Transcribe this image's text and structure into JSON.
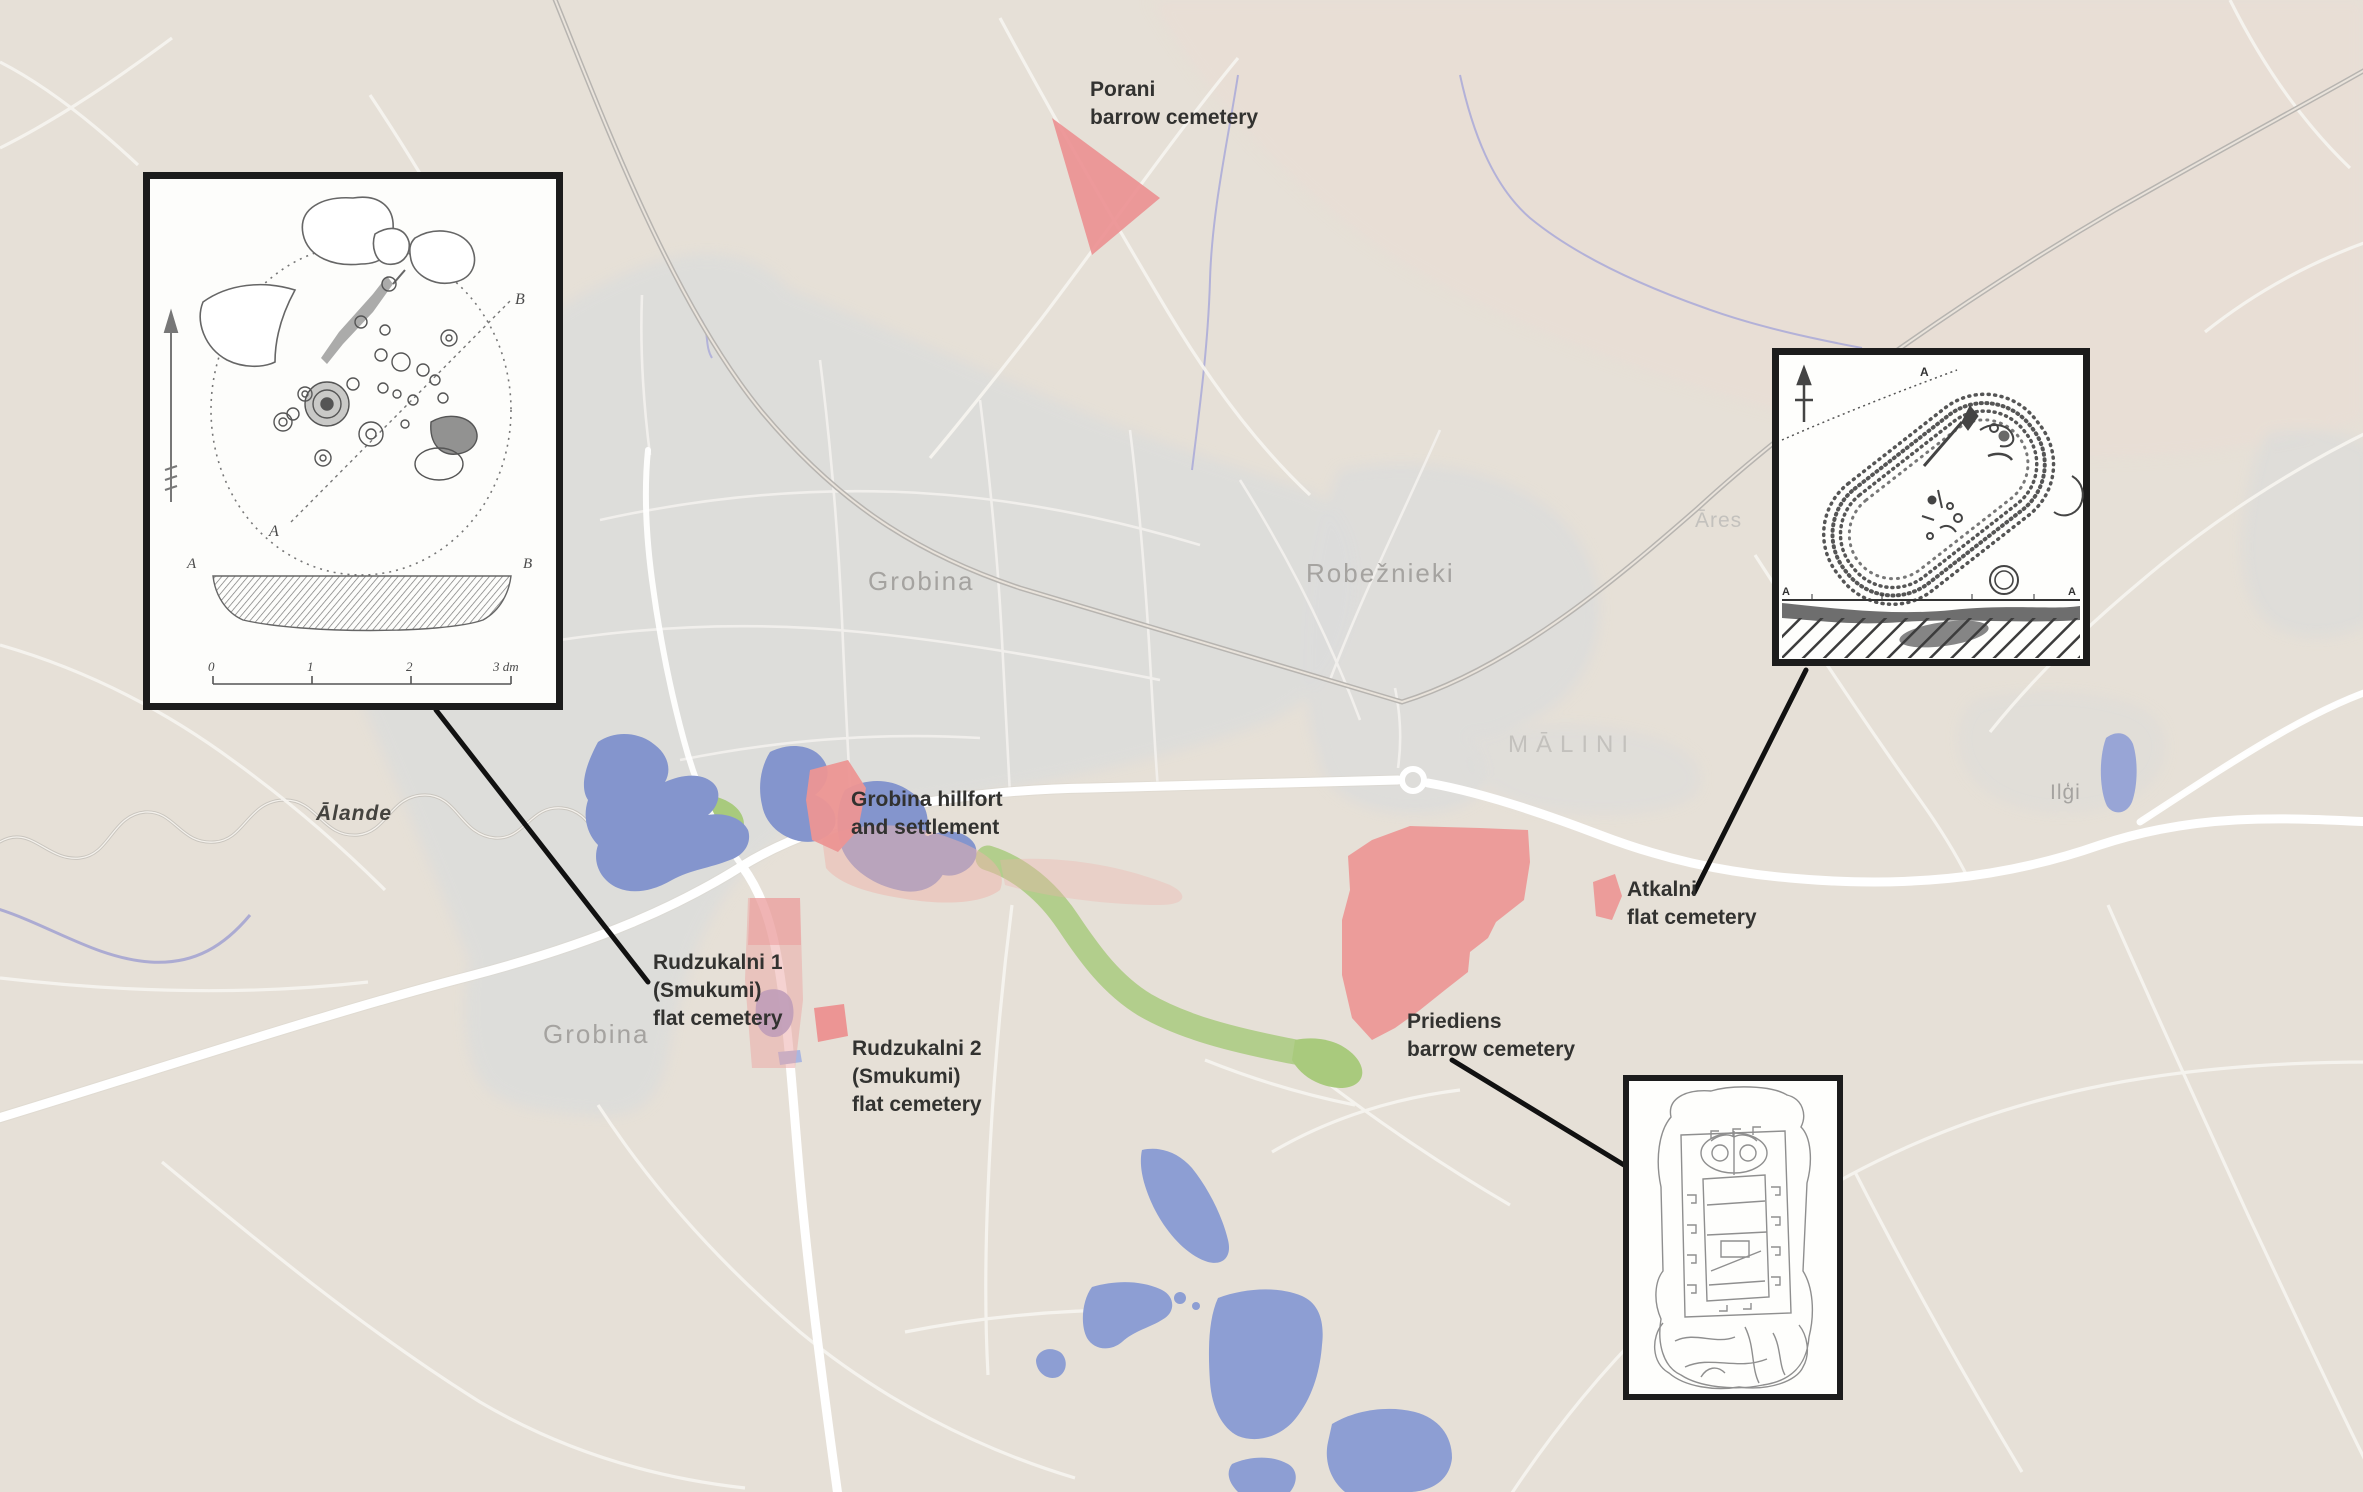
{
  "figure": {
    "type": "archaeological-sites-map",
    "region": "Grobiņa area"
  },
  "places": {
    "grobina_town": "Grobina",
    "grobina_sw": "Grobina",
    "robeznieki": "Robežnieki",
    "malini": "MĀLINI",
    "ares": "Āres",
    "ilgi": "Ilģi",
    "alande_river": "Ālande"
  },
  "sites": {
    "porani": {
      "line1": "Porani",
      "line2": "barrow cemetery"
    },
    "grobina_hillfort": {
      "line1": "Grobina hillfort",
      "line2": "and settlement"
    },
    "rudzukalni1": {
      "line1": "Rudzukalni 1",
      "line2": "(Smukumi)",
      "line3": "flat cemetery"
    },
    "rudzukalni2": {
      "line1": "Rudzukalni 2",
      "line2": "(Smukumi)",
      "line3": "flat cemetery"
    },
    "priediens": {
      "line1": "Priediens",
      "line2": "barrow cemetery"
    },
    "atkalni": {
      "line1": "Atkalni",
      "line2": "flat cemetery"
    }
  },
  "insets": {
    "barrow_plan": {
      "plan_label_a": "A",
      "plan_label_b": "B",
      "section_label_a": "A",
      "section_label_b": "B",
      "scale_0": "0",
      "scale_1": "1",
      "scale_2": "2",
      "scale_3": "3 dm"
    },
    "grave_plan": {
      "top_label": "A",
      "corner_label_left": "A",
      "corner_label_right": "A"
    },
    "picture_stone_drawing": {}
  },
  "legend_colors": {
    "site_area": "#ec9594",
    "site_area_faint": "#eeb3ac",
    "water": "#8d9ed3",
    "greenery": "#a2c873",
    "stream": "#a9a9d8",
    "builtup": "#dcdcda",
    "background": "#e6e0d7",
    "road": "#ffffff",
    "railway": "#b7b4b0",
    "connector": "#111111"
  }
}
